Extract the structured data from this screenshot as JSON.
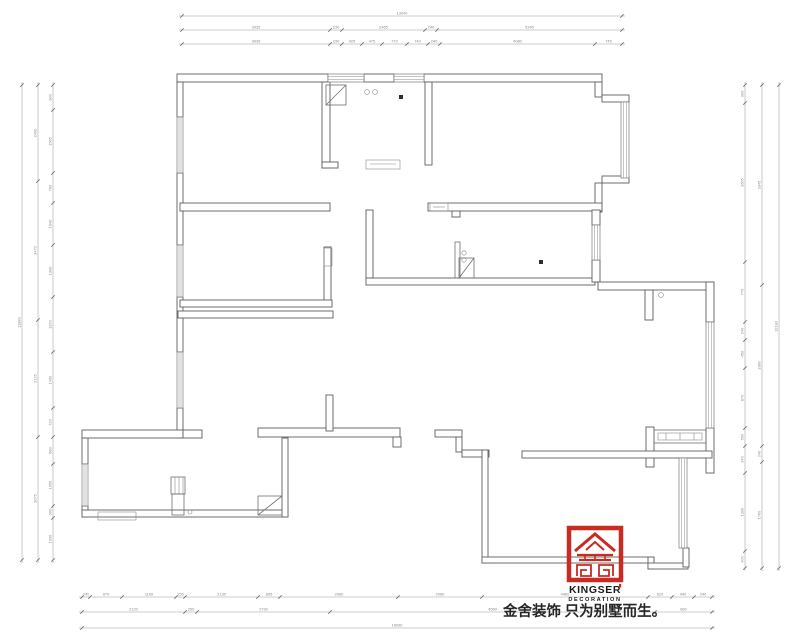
{
  "logo": {
    "brand": "KINGSER",
    "subtitle": "DECORATION",
    "slogan": "金舍装饰 只为别墅而生。",
    "accent_color": "#c92a22"
  },
  "drawing": {
    "type": "residential-floor-plan",
    "line_color": "#5f5f5f",
    "dimension_color": "#8a8a8a",
    "background": "#ffffff"
  },
  "dim_lines": [
    {
      "dir": "h",
      "at": 16,
      "ticks": [
        182,
        622
      ],
      "labels": [
        "13040"
      ]
    },
    {
      "dir": "h",
      "at": 30,
      "ticks": [
        182,
        330,
        342,
        425,
        437,
        622
      ],
      "labels": [
        "3935",
        "230",
        "2465",
        "240",
        "5245"
      ]
    },
    {
      "dir": "h",
      "at": 44,
      "ticks": [
        182,
        330,
        342,
        362,
        382,
        407,
        428,
        440,
        595,
        622
      ],
      "labels": [
        "3935",
        "230",
        "425",
        "475",
        "770",
        "740",
        "240",
        "4080",
        "745"
      ]
    },
    {
      "dir": "v",
      "at": 22,
      "ticks": [
        85,
        560
      ],
      "labels": [
        "11880"
      ]
    },
    {
      "dir": "v",
      "at": 38,
      "ticks": [
        85,
        181,
        320,
        437,
        560
      ],
      "labels": [
        "2400",
        "3470",
        "2125",
        "3075"
      ]
    },
    {
      "dir": "v",
      "at": 53,
      "ticks": [
        85,
        110,
        173,
        203,
        245,
        297,
        352,
        408,
        437,
        464,
        506,
        518,
        560
      ],
      "labels": [
        "900",
        "1565",
        "760",
        "1040",
        "1300",
        "1370",
        "1400",
        "720",
        "680",
        "1050",
        "300",
        "1050"
      ]
    },
    {
      "dir": "v",
      "at": 745,
      "ticks": [
        85,
        103,
        262,
        322,
        340,
        368,
        428,
        446,
        473,
        551,
        568
      ],
      "labels": [
        "300",
        "2605",
        "770",
        "240",
        "450",
        "870",
        "500",
        "240",
        "1300",
        "400"
      ]
    },
    {
      "dir": "v",
      "at": 762,
      "ticks": [
        85,
        285,
        446,
        462,
        568
      ],
      "labels": [
        "3345",
        "1980",
        "240",
        "1760"
      ]
    },
    {
      "dir": "v",
      "at": 779,
      "ticks": [
        85,
        568
      ],
      "labels": [
        "12180"
      ]
    },
    {
      "dir": "h",
      "at": 597,
      "ticks": [
        82,
        90,
        122,
        176,
        185,
        258,
        280,
        398,
        482,
        648,
        672,
        694,
        712
      ],
      "labels": [
        "240",
        "970",
        "1190",
        "250",
        "2135",
        "605",
        "2960",
        "2060",
        "4460",
        "620",
        "440",
        "240"
      ]
    },
    {
      "dir": "h",
      "at": 612,
      "ticks": [
        82,
        185,
        197,
        330,
        655,
        712
      ],
      "labels": [
        "2120",
        "250",
        "2730",
        "4560",
        "680"
      ]
    },
    {
      "dir": "h",
      "at": 628,
      "ticks": [
        82,
        712
      ],
      "labels": [
        "16090"
      ]
    }
  ]
}
